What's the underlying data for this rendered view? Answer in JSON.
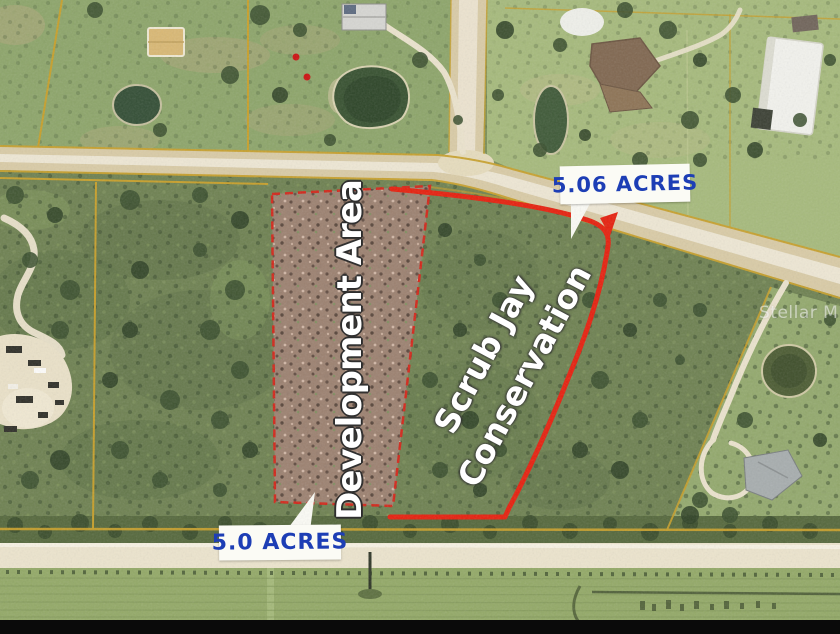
{
  "labels": {
    "acres_top": "5.06 ACRES",
    "acres_bottom": "5.0 ACRES",
    "development_area": "Development Area",
    "conservation_line1": "Scrub Jay",
    "conservation_line2": "Conservation"
  },
  "watermark": "Stellar MLS",
  "colors": {
    "label_blue": "#1d3eb5",
    "boundary_red": "#e32410",
    "parcel_yellow": "#c79f2a",
    "callout_white": "#fbfbf5",
    "development_fill": "#a08173"
  }
}
